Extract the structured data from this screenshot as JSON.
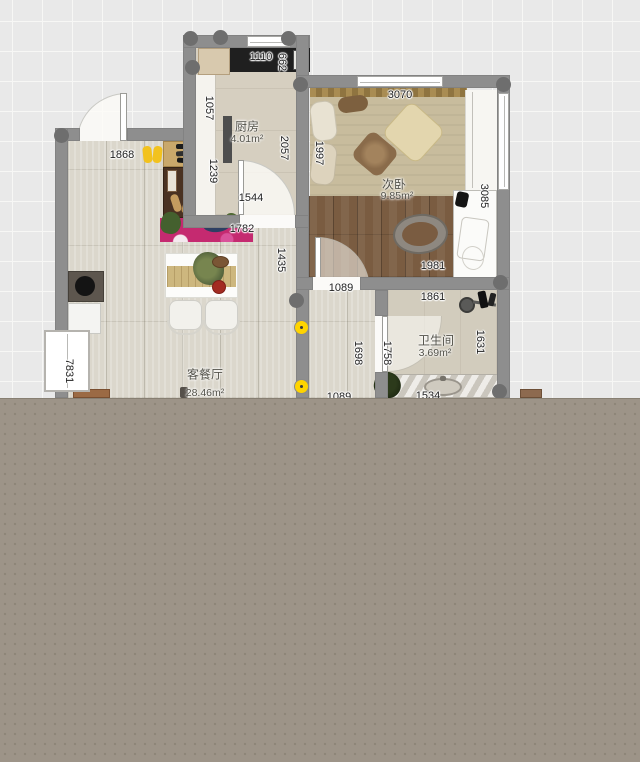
{
  "rooms": {
    "kitchen": {
      "name": "厨房",
      "area": "4.01m²"
    },
    "bedroom": {
      "name": "次卧",
      "area": "9.85m²"
    },
    "bathroom": {
      "name": "卫生间",
      "area": "3.69m²"
    },
    "living": {
      "name": "客餐厅",
      "area": "28.46m²"
    }
  },
  "dimensions": {
    "counter_top": "1110",
    "counter_side": "662",
    "kitchen_left_upper": "1057",
    "kitchen_left_lower": "1239",
    "kitchen_right": "2057",
    "kitchen_door": "1544",
    "entry_width": "1868",
    "rug_width": "1782",
    "dining_side": "1435",
    "bed_width": "3070",
    "bed_depth": "1997",
    "bedroom_right": "3085",
    "bedroom_bottom": "1981",
    "bedroom_door": "1089",
    "bathroom_width": "1861",
    "bathroom_right": "1631",
    "bathroom_door": "1758",
    "hall_height": "1698",
    "hall_bottom": "1089",
    "vanity_width": "1534",
    "left_wall": "7831"
  },
  "colors": {
    "wall": "#8e8e8e",
    "column": "#6e6e6e",
    "marker_yellow": "#ffd400",
    "rug_pink": "#c52a70",
    "overlay_gray": "#9d9488",
    "wood_floor": "#7a5c41",
    "bed_tan": "#c8bc9d"
  }
}
